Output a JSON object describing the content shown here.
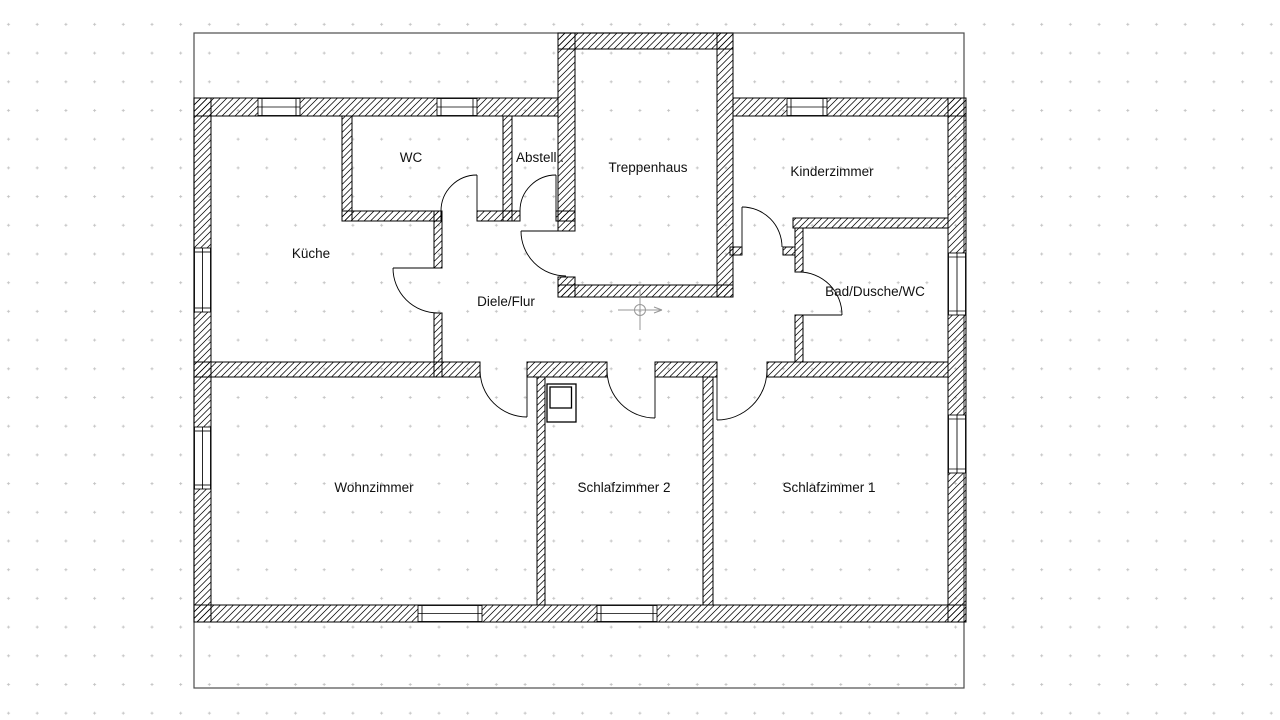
{
  "drawing": {
    "type": "floor-plan",
    "background": "#ffffff",
    "line_color": "#000000",
    "hatch_color": "#000000",
    "grid_dot_color": "#c3c3c3",
    "origin_marker_color": "#979797",
    "frame_color": "#4d4d4d",
    "window_fill": "#ffffff"
  },
  "symbols": {
    "origin_marker": "drawing-origin-crosshair",
    "chimney": "chimney-flue-box",
    "door_arc": "door-swing-quarter-circle",
    "window": "double-line-window"
  },
  "rooms": [
    {
      "id": "kueche",
      "label": "Küche"
    },
    {
      "id": "wc",
      "label": "WC"
    },
    {
      "id": "abstellraum",
      "label": "Abstellr."
    },
    {
      "id": "treppenhaus",
      "label": "Treppenhaus"
    },
    {
      "id": "kinderzimmer",
      "label": "Kinderzimmer"
    },
    {
      "id": "diele-flur",
      "label": "Diele/Flur"
    },
    {
      "id": "bad",
      "label": "Bad/Dusche/WC"
    },
    {
      "id": "wohnzimmer",
      "label": "Wohnzimmer"
    },
    {
      "id": "schlafzimmer2",
      "label": "Schlafzimmer 2"
    },
    {
      "id": "schlafzimmer1",
      "label": "Schlafzimmer 1"
    }
  ],
  "counts": {
    "doors": 9,
    "windows": 9
  }
}
